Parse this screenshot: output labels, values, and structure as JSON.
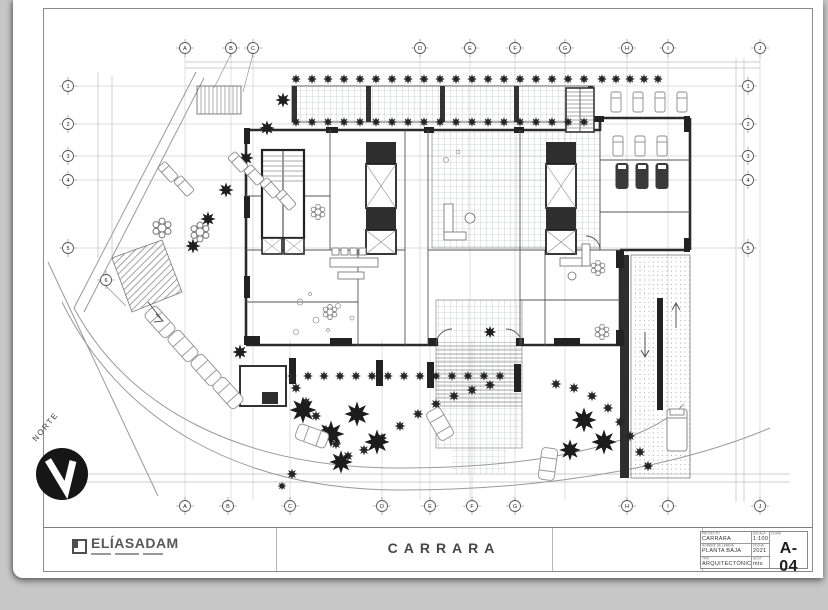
{
  "sheet": {
    "project_title": "CARRARA",
    "logo": {
      "text": "ELÍASADAM"
    },
    "north_label": "NORTE",
    "title_block": {
      "proyecto_label": "PROYECTO",
      "proyecto_value": "CARRARA",
      "lamina_label": "NOMBRE DE LÁMINA",
      "lamina_value": "PLANTA BAJA",
      "tipo_label": "TIPO",
      "tipo_value": "ARQUITECTÓNICO",
      "escala_label": "ESCALA",
      "escala_value": "1:100",
      "fecha_label": "FECHA",
      "fecha_value": "2021",
      "acot_label": "ACOT",
      "acot_value": "mts",
      "clave_label": "CLAVE",
      "clave_value": "A-04"
    },
    "grid": {
      "top": [
        "A",
        "B",
        "C",
        "D",
        "E",
        "F",
        "G",
        "H",
        "I",
        "J"
      ],
      "bottom": [
        "A",
        "B",
        "C",
        "D",
        "E",
        "F",
        "G",
        "H",
        "I",
        "J"
      ],
      "left": [
        "1",
        "2",
        "3",
        "4",
        "5",
        "6"
      ],
      "right": [
        "1",
        "2",
        "3",
        "4",
        "5"
      ]
    }
  }
}
